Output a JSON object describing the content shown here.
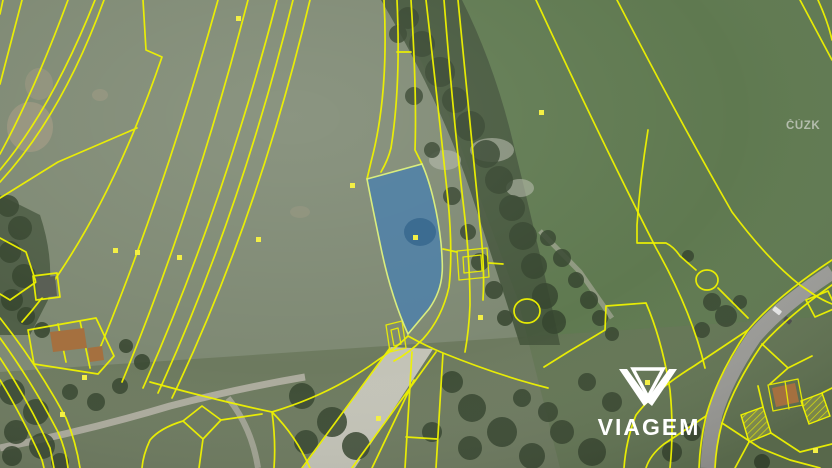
{
  "map": {
    "kind": "cadastral-parcel-overlay-on-aerial-photo",
    "source_watermark": "ČÚZK",
    "brand_logo_text": "VIAGEM",
    "highlighted_parcel": {
      "description": "subject parcel highlighted blue in map center"
    },
    "colors": {
      "parcel_line": "#eef200",
      "highlight_fill": "#4a80ae",
      "highlight_outline": "#d9ed7e",
      "field_left": "#7e8973",
      "field_right": "#5f7950",
      "pasture": "#667457",
      "woods": "#45553c",
      "tree": "#36452f",
      "road_asphalt": "#9d9d99",
      "road_dirt": "#cbc9bf",
      "track": "#b7b4a8",
      "soil_patch": "#a59a82",
      "rock_patch": "#b3b7a8",
      "roof_red": "#a5703f",
      "roof_dark": "#5a5f55",
      "marker": "#f3ef45",
      "watermark_text": "#c3c9bd",
      "logo": "#ffffff"
    }
  }
}
